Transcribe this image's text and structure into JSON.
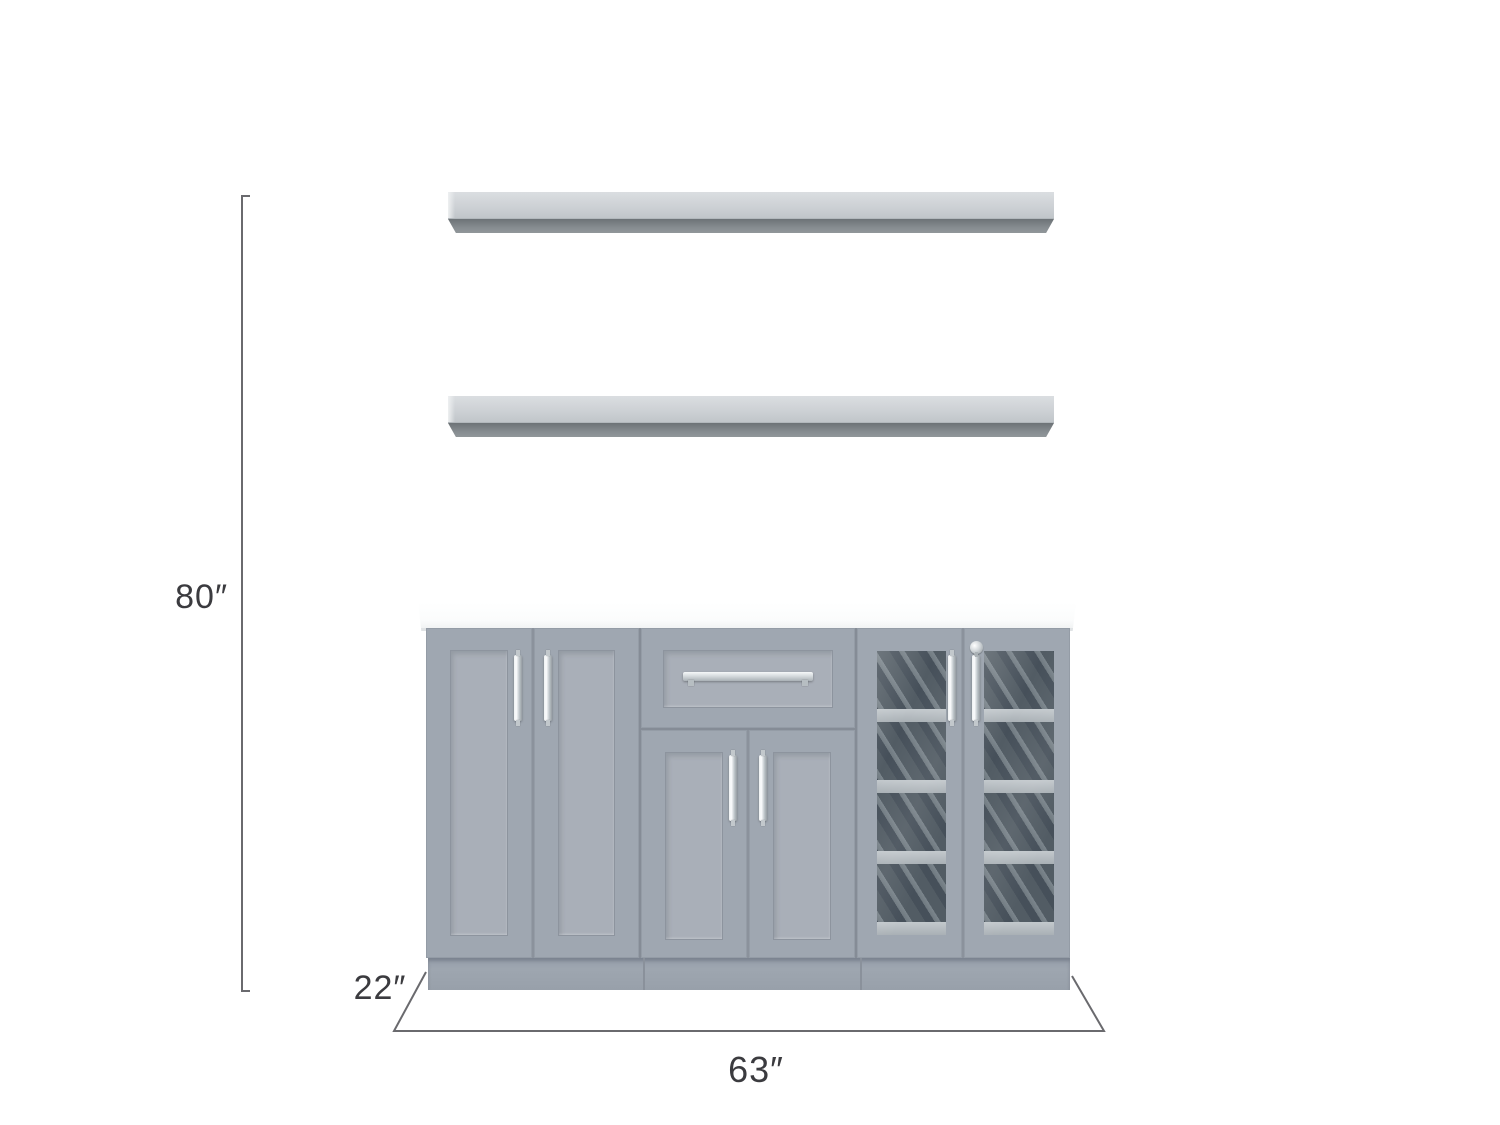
{
  "page": {
    "background": "#ffffff",
    "description": "Dimension diagram of a gray home bar cabinet set: two floating wall shelves above a 3-section cabinet with white countertop"
  },
  "dimension_labels": {
    "height": "80″",
    "depth": "22″",
    "width": "63″"
  },
  "colors": {
    "cabinet_gray": "#9ca4ae",
    "door_panel_gray": "#a9afb8",
    "countertop_white": "#fcfdfd",
    "shelf_top_gray": "#ccd0d4",
    "shelf_underside_gray": "#7d8387",
    "hardware_chrome": "#d9dee1",
    "glass_tint": "#636d73",
    "rack_shelf_band": "#b6bdc1",
    "dimension_line": "#6a6a6e",
    "dimension_text": "#3b3b3f"
  },
  "product": {
    "floating_shelves": 2,
    "sections": [
      "two-door-cabinet",
      "drawer-over-two-doors",
      "two-glass-door-display"
    ],
    "wine_rack_rows_per_glass_door": 4,
    "has_lock": true
  }
}
